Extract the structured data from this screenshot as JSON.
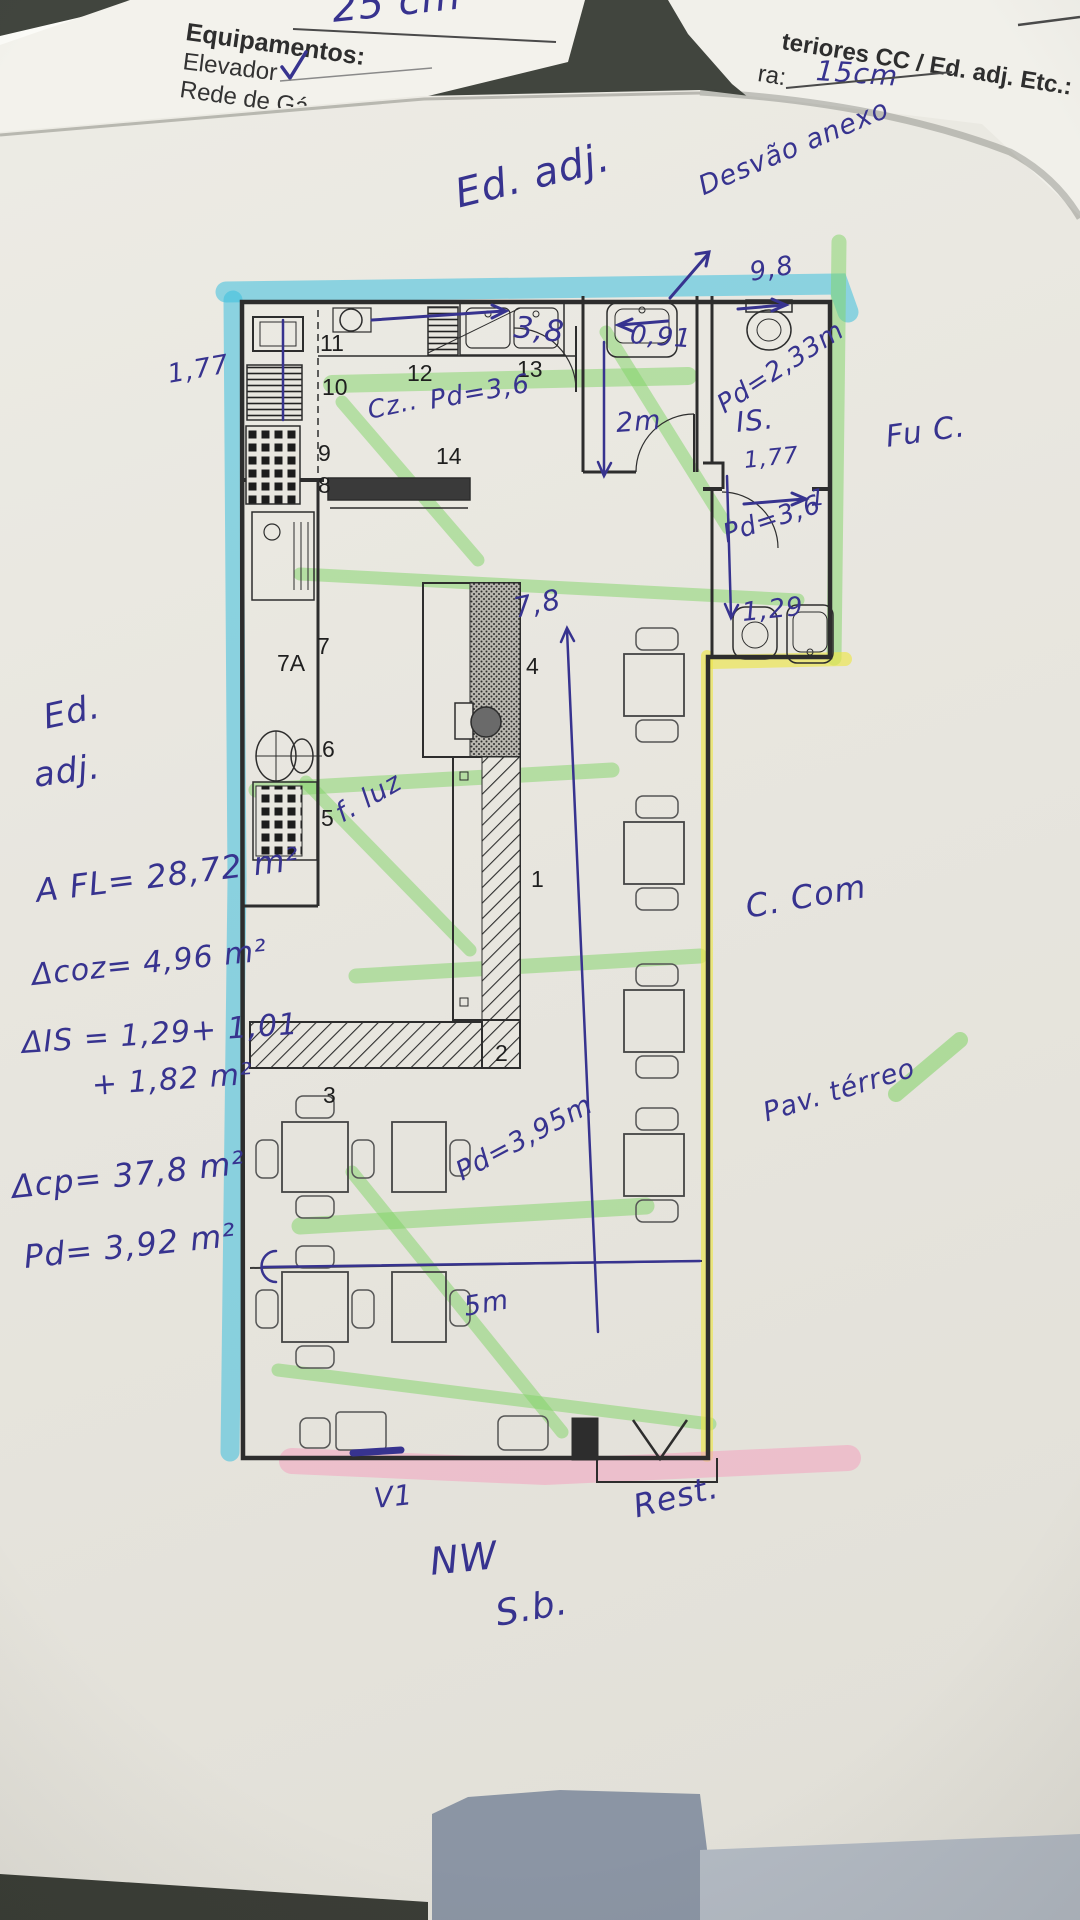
{
  "form": {
    "note_25cm": "25 cm",
    "heading": "Equipamentos:",
    "item_elevador": "Elevador",
    "item_rede": "Rede de Gá",
    "right_line1": "teriores CC / Ed. adj. Etc.:",
    "right_ra": "ra:",
    "right_value": "15cm"
  },
  "rooms": {
    "r1": "1",
    "r2": "2",
    "r3": "3",
    "r4": "4",
    "r5": "5",
    "r6": "6",
    "r7": "7",
    "r7a": "7A",
    "r8": "8",
    "r9": "9",
    "r10": "10",
    "r11": "11",
    "r12": "12",
    "r13": "13",
    "r14": "14"
  },
  "annotations": {
    "ed_adj_top": "Ed. adj.",
    "desvao_anexo": "Desvão anexo",
    "dim_9_8": "9,8",
    "dim_3_8": "3,8",
    "dim_0_91": "0,91",
    "pd_2_33": "Pd=2,33m",
    "is_label": "IS.",
    "dim_1_77_right": "1,77",
    "dim_2m": "2m",
    "dim_1_77_left": "1,77",
    "cz": "Cz..",
    "pd_3_6_top": "Pd=3,6",
    "one_dash": "1",
    "pd_3_6_right": "Pd=3,6",
    "dim_1_29": "1,29",
    "dim_7_8": "7,8",
    "f_luz": "f. luz",
    "ed_left_1": "Ed.",
    "ed_left_2": "adj.",
    "area_fl": "A FL= 28,72 m²",
    "area_coz": "Δcoz= 4,96 m²",
    "area_is_1": "ΔIS = 1,29+ 1,01",
    "area_is_2": "+ 1,82 m²",
    "area_cp": "Δcp=  37,8 m²",
    "pd_3_92": "Pd= 3,92 m²",
    "c_com": "C. Com",
    "pav_terreo": "Pav. térreo",
    "pd_3_95": "Pd=3,95m",
    "dim_5m": "5m",
    "v1": "V1",
    "rest": "Rest.",
    "nw": "NW",
    "sb": "S.b.",
    "fu_c": "Fu C."
  },
  "colors": {
    "highlighter_cyan": "#3cc0de",
    "highlighter_green": "#7fd465",
    "highlighter_yellow": "#ece64a",
    "highlighter_pink": "#f2a9c2",
    "ink_blue": "#37338f",
    "print_black": "#2d2d2d",
    "paper": "#e8e6df",
    "table": "#41453e"
  }
}
